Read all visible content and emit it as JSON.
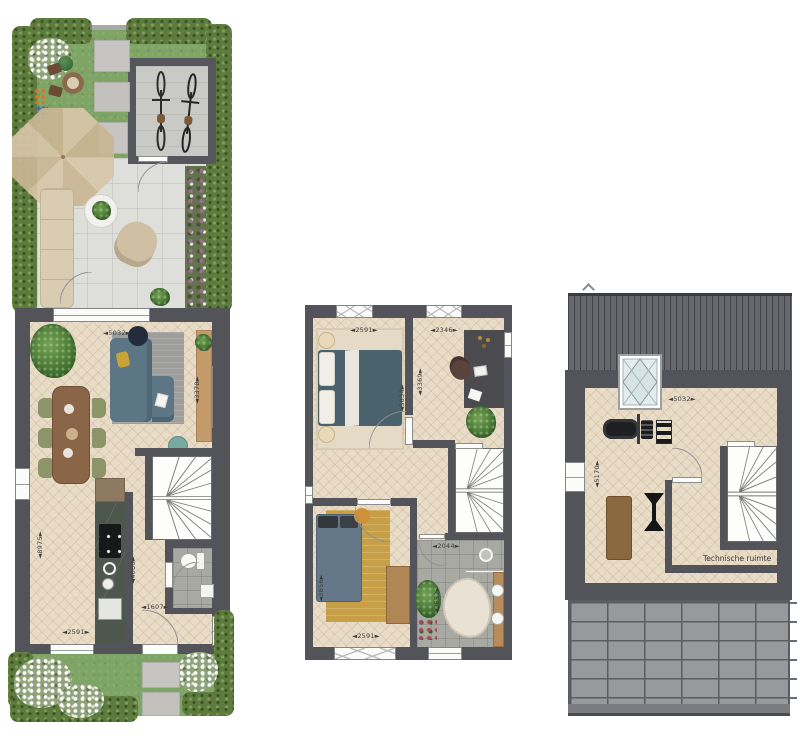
{
  "palette": {
    "background": "#ffffff",
    "wall": "#53545a",
    "wood_floor": "#e9dcc7",
    "grass": "#7ea566",
    "hedge": "#5d7b3d",
    "terrace_tile": "#dededa",
    "bathroom_tile": "#a9a9a3",
    "roof": "#67686d",
    "roof_panels": "#98999c",
    "sofa_blue": "#5d7686",
    "wood_furniture": "#b98c5c"
  },
  "plans": {
    "ground": {
      "dims": {
        "width_top": "◄5032►",
        "living_depth": "◄3378►",
        "total_depth": "◄8975►",
        "hall_depth": "◄4080►",
        "hall_width": "◄1607►",
        "kitchen_window_width": "◄2591►"
      }
    },
    "first": {
      "dims": {
        "bedroom1_width": "◄2591►",
        "bedroom1_depth": "◄5034►",
        "study_width": "◄2346►",
        "study_depth": "◄3369►",
        "bedroom2_width": "◄2591►",
        "bedroom2_depth": "◄3856►",
        "bathroom_width": "◄2044►",
        "bathroom_depth": "◄2652►"
      }
    },
    "attic": {
      "dims": {
        "width_top": "◄5032►",
        "room_depth": "◄5170►"
      },
      "labels": {
        "technical_room": "Technische ruimte"
      }
    }
  }
}
